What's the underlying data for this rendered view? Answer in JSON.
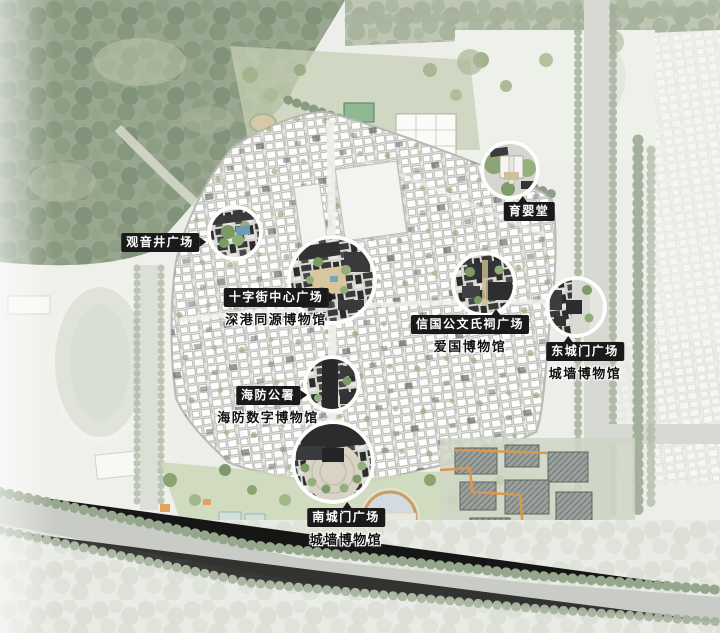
{
  "page": {
    "type": "historic-town-masterplan-map"
  },
  "labels": {
    "guanyinjing": {
      "title": "观音井广场"
    },
    "yuyingtang": {
      "title": "育婴堂"
    },
    "shizijie": {
      "title": "十字街中心广场",
      "subtitle": "深港同源博物馆"
    },
    "xinguogong": {
      "title": "信国公文氏祠广场",
      "subtitle": "爱国博物馆"
    },
    "dongchengmen": {
      "title": "东城门广场",
      "subtitle": "城墙博物馆"
    },
    "haifang": {
      "title": "海防公署",
      "subtitle": "海防数字博物馆"
    },
    "nanchengmen": {
      "title": "南城门广场",
      "subtitle": "城墙博物馆"
    }
  },
  "colors": {
    "label_bg": "#1a1a1a",
    "label_text": "#ffffff",
    "subtitle_text": "#101010",
    "subtitle_halo": "#ffffff",
    "forest_green": "#93a28b",
    "town_fabric_bg": "#e4e5e0",
    "road_gray": "#d6d8d2",
    "tree_row_green": "#9fac97",
    "dark_roof": "#333335",
    "pond_water": "#d2dce0",
    "pond_rim": "#c99e63",
    "path_orange": "#d9984f",
    "callout_border": "#fdfdfb"
  }
}
